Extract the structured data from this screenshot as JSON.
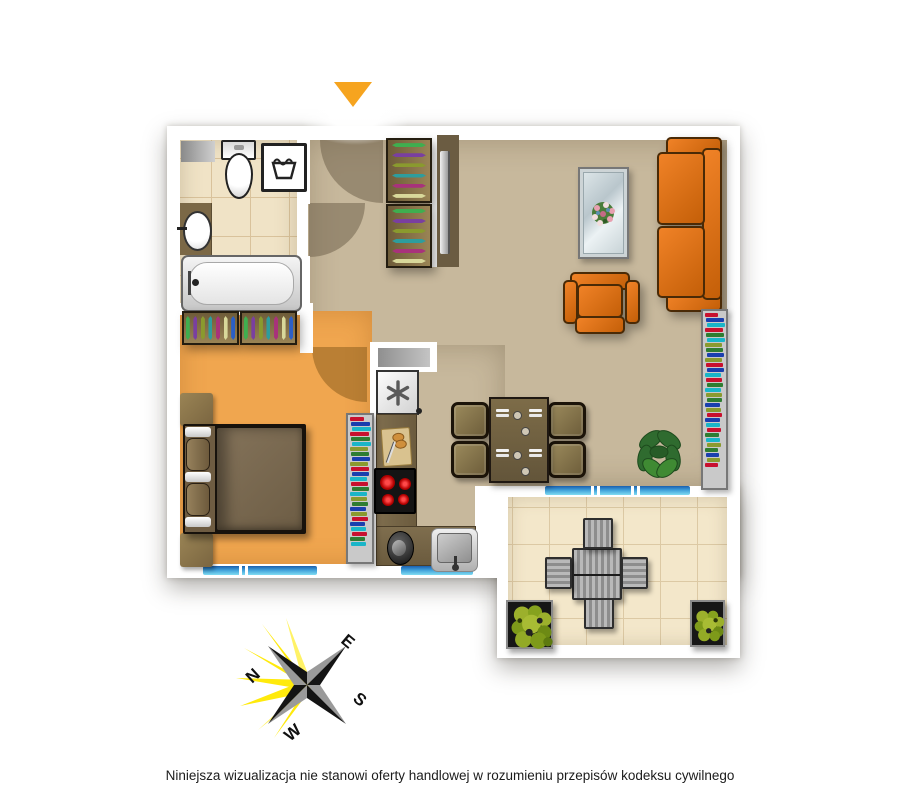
{
  "disclaimer": {
    "text": "Niniejsza wizualizacja nie stanowi oferty handlowej w rozumieniu przepisów kodeksu cywilnego"
  },
  "compass": {
    "labels": {
      "n": "N",
      "e": "E",
      "s": "S",
      "w": "W"
    }
  },
  "icons": {
    "entrance_arrow": "triangle-down",
    "fridge": "asterisk-snowflake",
    "washer": "laundry-tub",
    "compass": "compass-rose"
  },
  "colors": {
    "wall": "#ffffff",
    "floor-living": "#c7b89c",
    "floor-bedroom": "#f0a64f",
    "floor-bath": "#f0e3c6",
    "floor-balcony": "#f3e7ca",
    "counter": "#77674a",
    "sofa": "#e2710f",
    "sofa-dark": "#c45f08",
    "wood-dark": "#241d10",
    "duvet": "#7b6a4f",
    "tv-panel": "#6b5c42",
    "arrow": "#f6a41f",
    "window-a": "#1a5fae",
    "window-b": "#7fdcf2",
    "compass-yellow": "#ffe900"
  },
  "palettes": {
    "hangers": [
      "#3fae4f",
      "#7a3fa0",
      "#8a9a2e",
      "#2e9d9d",
      "#a8327b",
      "#d8d89a",
      "#2b5fc7"
    ],
    "books": [
      "#c8102e",
      "#f2c500",
      "#2e7d32",
      "#ffffff",
      "#1a3fae",
      "#b31aae",
      "#19b5c8",
      "#7a1010",
      "#8a9a2e",
      "#e87722"
    ]
  }
}
